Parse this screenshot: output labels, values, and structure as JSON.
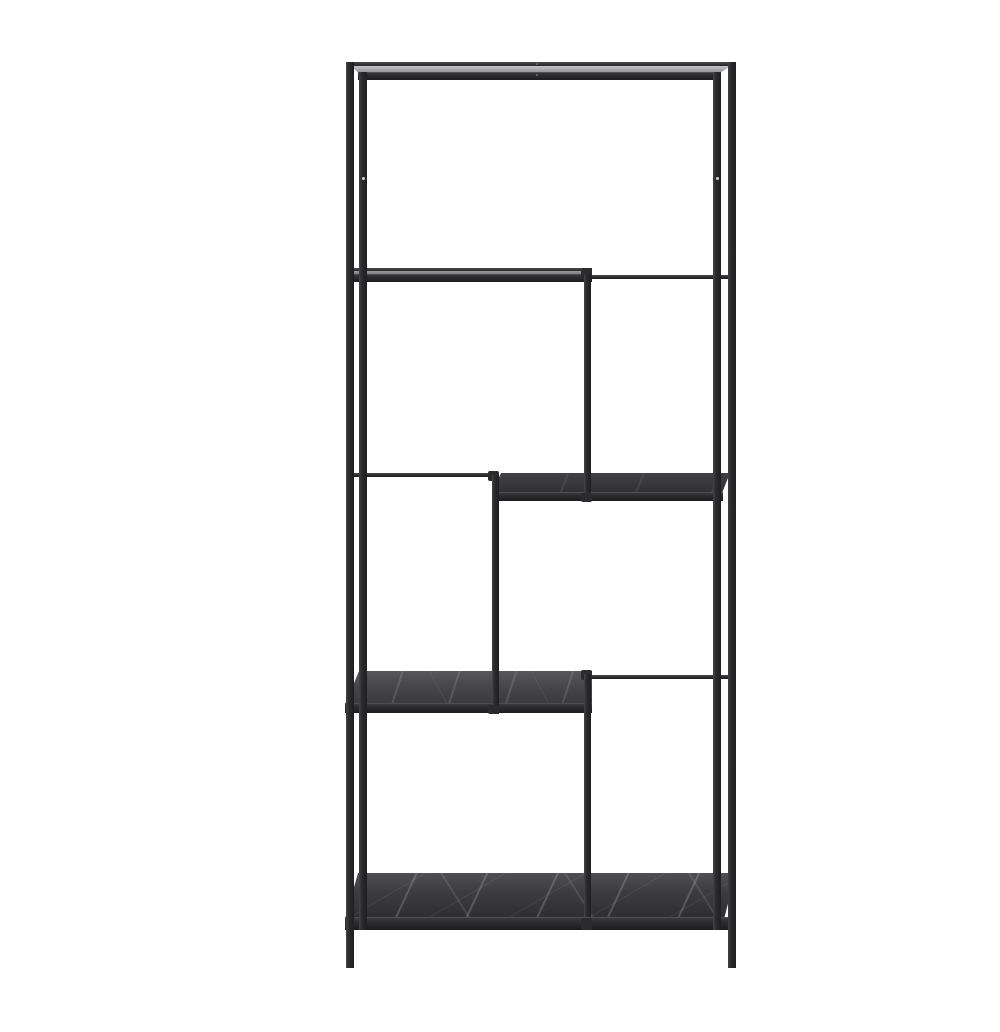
{
  "scene": {
    "type": "product-photo",
    "subject": "Black metal asymmetric shelving unit with dark marble-effect shelves on a white background",
    "shelf_count": 5
  },
  "colors": {
    "background": "#ffffff",
    "frame": "#2b2b2d",
    "shelf_glare": "#c3c3c5",
    "marble_base": "#3c3c3f",
    "marble_vein": "#cdcdd2",
    "screw_dot": "#d2d2d4"
  },
  "parts": {
    "posts": [
      {
        "name": "post-back-left",
        "label": "back left post"
      },
      {
        "name": "post-front-left",
        "label": "front left post"
      },
      {
        "name": "post-front-right",
        "label": "front right post"
      },
      {
        "name": "post-back-right",
        "label": "back right post"
      },
      {
        "name": "mid-post-a",
        "label": "middle post between shelf 2 and shelf 3"
      },
      {
        "name": "mid-post-b",
        "label": "middle post between shelf 3 and shelf 4"
      },
      {
        "name": "mid-post-c",
        "label": "middle post between shelf 4 and bottom shelf"
      }
    ],
    "shelves": [
      {
        "name": "shelf-1",
        "label": "top shelf, full width"
      },
      {
        "name": "shelf-2",
        "label": "upper shelf, left half"
      },
      {
        "name": "shelf-3",
        "label": "middle shelf, right half, marble effect"
      },
      {
        "name": "shelf-4",
        "label": "lower shelf, left half, marble effect"
      },
      {
        "name": "shelf-5",
        "label": "bottom shelf, full width, marble effect"
      }
    ]
  }
}
